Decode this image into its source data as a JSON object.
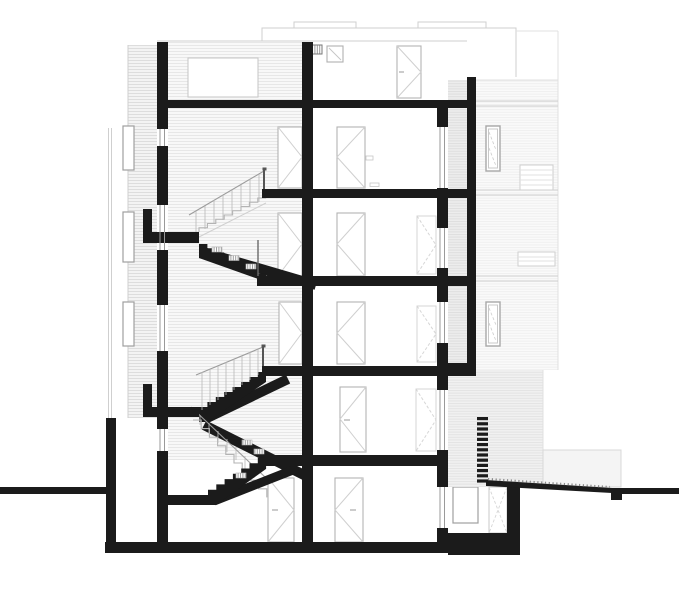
{
  "drawing": {
    "title": "Building cross-section drawing",
    "type": "architectural-section",
    "orientation": "transverse section through stair hall",
    "levels": 5,
    "text_labels": [],
    "components": [
      {
        "name": "left-facade-siding",
        "kind": "elevation-hatch"
      },
      {
        "name": "left-exterior-wall",
        "kind": "cut-wall"
      },
      {
        "name": "central-wall",
        "kind": "cut-wall"
      },
      {
        "name": "right-inner-wall",
        "kind": "cut-wall"
      },
      {
        "name": "right-outer-wall",
        "kind": "cut-wall"
      },
      {
        "name": "floor-slabs",
        "kind": "cut-slab",
        "count": 6
      },
      {
        "name": "stair-landings",
        "kind": "cut-slab",
        "count": 2
      },
      {
        "name": "switchback-stair",
        "kind": "stair",
        "runs": 6
      },
      {
        "name": "doors",
        "kind": "elevation-door",
        "count": 10
      },
      {
        "name": "windows",
        "kind": "glazing",
        "count": 9
      },
      {
        "name": "foundation",
        "kind": "cut-foundation"
      },
      {
        "name": "ground-line",
        "kind": "terrain"
      },
      {
        "name": "neighbor-building",
        "kind": "background-elevation"
      },
      {
        "name": "exterior-steps",
        "kind": "stair-section"
      }
    ]
  },
  "colors": {
    "paper": "#ffffff",
    "ink": "#1b1b1b",
    "line": "#b3b3b3",
    "faint": "#cfcfcf",
    "vfaint": "#e0e0e0",
    "hatch_bg": "#f8f8f8",
    "hatch_line": "#e7e7e7",
    "board_bg": "#f3f3f3",
    "board_line": "#dddddd",
    "shaft_bg": "#ededed",
    "shaft_line": "#dedede",
    "facade_bg": "#fafafa",
    "facade_line": "#efefef",
    "annex_bg": "#f1f1f1",
    "annex_line": "#e3e3e3"
  }
}
